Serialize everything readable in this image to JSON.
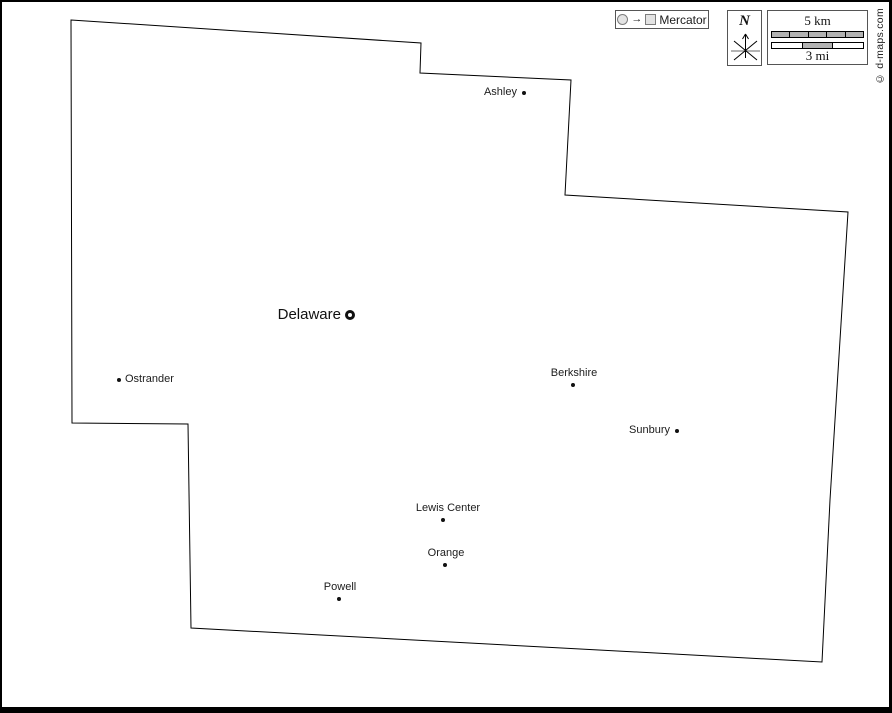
{
  "projection_legend": {
    "label": "Mercator",
    "arrow": "→"
  },
  "compass": {
    "north_label": "N"
  },
  "scale_bar": {
    "km_label": "5 km",
    "mi_label": "3 mi",
    "km_segments": 5,
    "mi_segments": 3,
    "mi_filled_segment": 1,
    "bar_fill_color": "#b3b3b3",
    "bar_empty_color": "#ffffff"
  },
  "copyright": "© d-maps.com",
  "colors": {
    "county_outline": "#000000",
    "marker": "#111111",
    "legend_border": "#555555"
  },
  "county_outline_points": [
    [
      71,
      20
    ],
    [
      421,
      43
    ],
    [
      420,
      73
    ],
    [
      571,
      80
    ],
    [
      565,
      195
    ],
    [
      848,
      212
    ],
    [
      830,
      500
    ],
    [
      822,
      662
    ],
    [
      191,
      628
    ],
    [
      188,
      424
    ],
    [
      72,
      423
    ]
  ],
  "cities": [
    {
      "name": "Ashley",
      "x": 524,
      "y": 93,
      "label_side": "left",
      "type": "town"
    },
    {
      "name": "Delaware",
      "x": 350,
      "y": 315,
      "label_side": "left",
      "type": "county_seat"
    },
    {
      "name": "Ostrander",
      "x": 119,
      "y": 380,
      "label_side": "right",
      "type": "town"
    },
    {
      "name": "Berkshire",
      "x": 573,
      "y": 385,
      "label_side": "above",
      "type": "town",
      "label_dx": 1
    },
    {
      "name": "Sunbury",
      "x": 677,
      "y": 431,
      "label_side": "left",
      "type": "town"
    },
    {
      "name": "Lewis Center",
      "x": 443,
      "y": 520,
      "label_side": "above",
      "type": "town",
      "label_dx": 5
    },
    {
      "name": "Orange",
      "x": 445,
      "y": 565,
      "label_side": "above",
      "type": "town",
      "label_dx": 1
    },
    {
      "name": "Powell",
      "x": 339,
      "y": 599,
      "label_side": "above",
      "type": "town",
      "label_dx": 1
    }
  ]
}
